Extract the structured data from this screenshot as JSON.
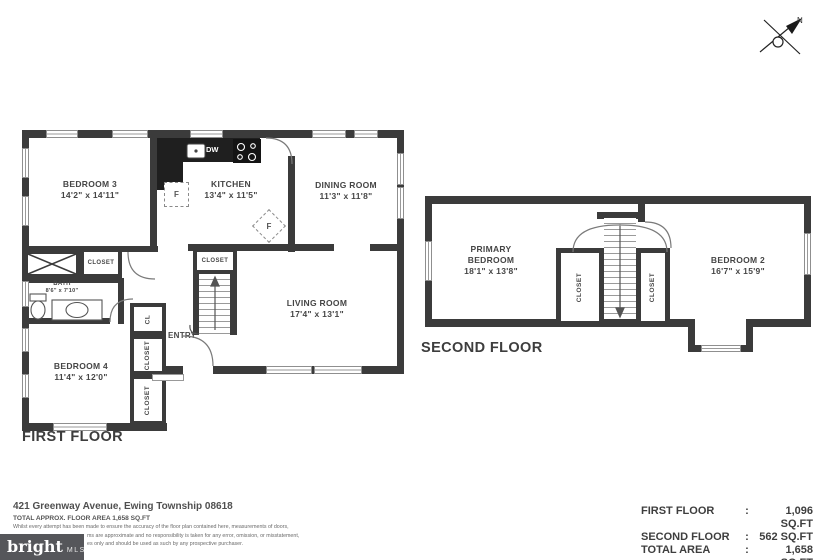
{
  "compass": {
    "north": "N"
  },
  "first_floor": {
    "title": "FIRST FLOOR",
    "bedroom3": {
      "name": "BEDROOM 3",
      "dims": "14'2\" x 14'11\""
    },
    "kitchen": {
      "name": "KITCHEN",
      "dims": "13'4\" x 11'5\""
    },
    "dining": {
      "name": "DINING ROOM",
      "dims": "11'3\" x  11'8\""
    },
    "living": {
      "name": "LIVING ROOM",
      "dims": "17'4\" x 13'1\""
    },
    "bedroom4": {
      "name": "BEDROOM 4",
      "dims": "11'4\" x 12'0\""
    },
    "bath": {
      "name": "BATH",
      "dims": "8'6\" x 7'10\""
    },
    "entry": "ENTRY",
    "closet": "CLOSET",
    "cl": "CL",
    "dw": "DW",
    "f": "F"
  },
  "second_floor": {
    "title": "SECOND FLOOR",
    "primary": {
      "name1": "PRIMARY",
      "name2": "BEDROOM",
      "dims": "18'1\" x 13'8\""
    },
    "bedroom2": {
      "name": "BEDROOM 2",
      "dims": "16'7\" x 15'9\""
    },
    "closet": "CLOSET"
  },
  "footer": {
    "address": "421 Greenway Avenue, Ewing Township 08618",
    "area_note": "TOTAL APPROX. FLOOR AREA 1,658 SQ.FT",
    "disclaimer1": "Whilst every attempt has been made to ensure the accuracy of the floor plan contained here, measurements of doors,",
    "disclaimer2": "ms are approximate and no responsibility is taken for any error, omission, or misstatement,",
    "disclaimer3": "es only and should be used as such by any prospective purchaser.",
    "logo": {
      "brand": "bright",
      "mls": "MLS"
    },
    "summary": [
      {
        "label": "FIRST FLOOR",
        "colon": ":",
        "value": "1,096 SQ.FT"
      },
      {
        "label": "SECOND FLOOR",
        "colon": ":",
        "value": "562 SQ.FT"
      },
      {
        "label": "TOTAL AREA",
        "colon": ":",
        "value": "1,658 SQ.FT"
      }
    ]
  }
}
